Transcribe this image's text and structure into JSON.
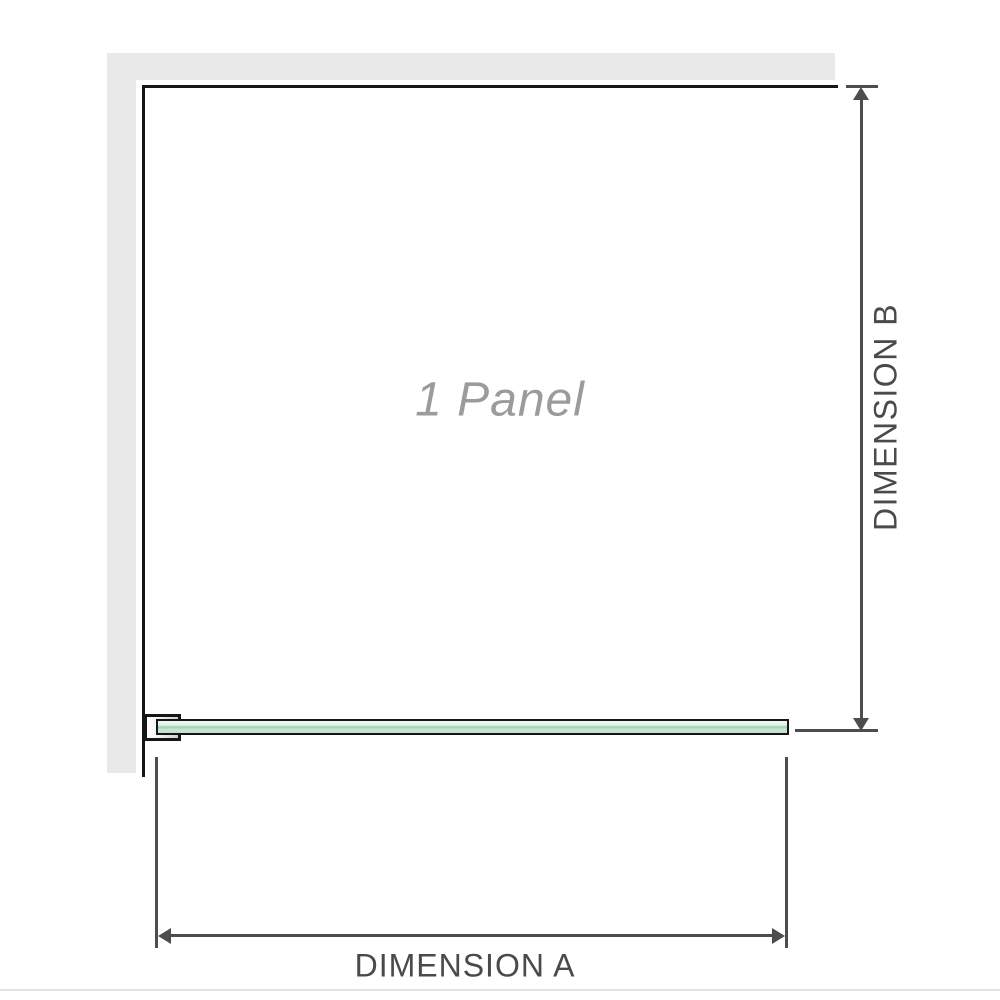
{
  "diagram": {
    "panel_label": "1 Panel",
    "dimension_a_label": "DIMENSION A",
    "dimension_b_label": "DIMENSION B",
    "colors": {
      "wall": "#e9e9e9",
      "panel_outline": "#161616",
      "dimension_line": "#4d4d4d",
      "dimension_text": "#4a4a4a",
      "panel_label_text": "#9b9b9b",
      "glass_green_light": "#e3f2e8",
      "glass_green_mid": "#9cd2b2",
      "bracket_gray": "#cfcfcf",
      "footer_rule": "#e2e2e2"
    }
  }
}
